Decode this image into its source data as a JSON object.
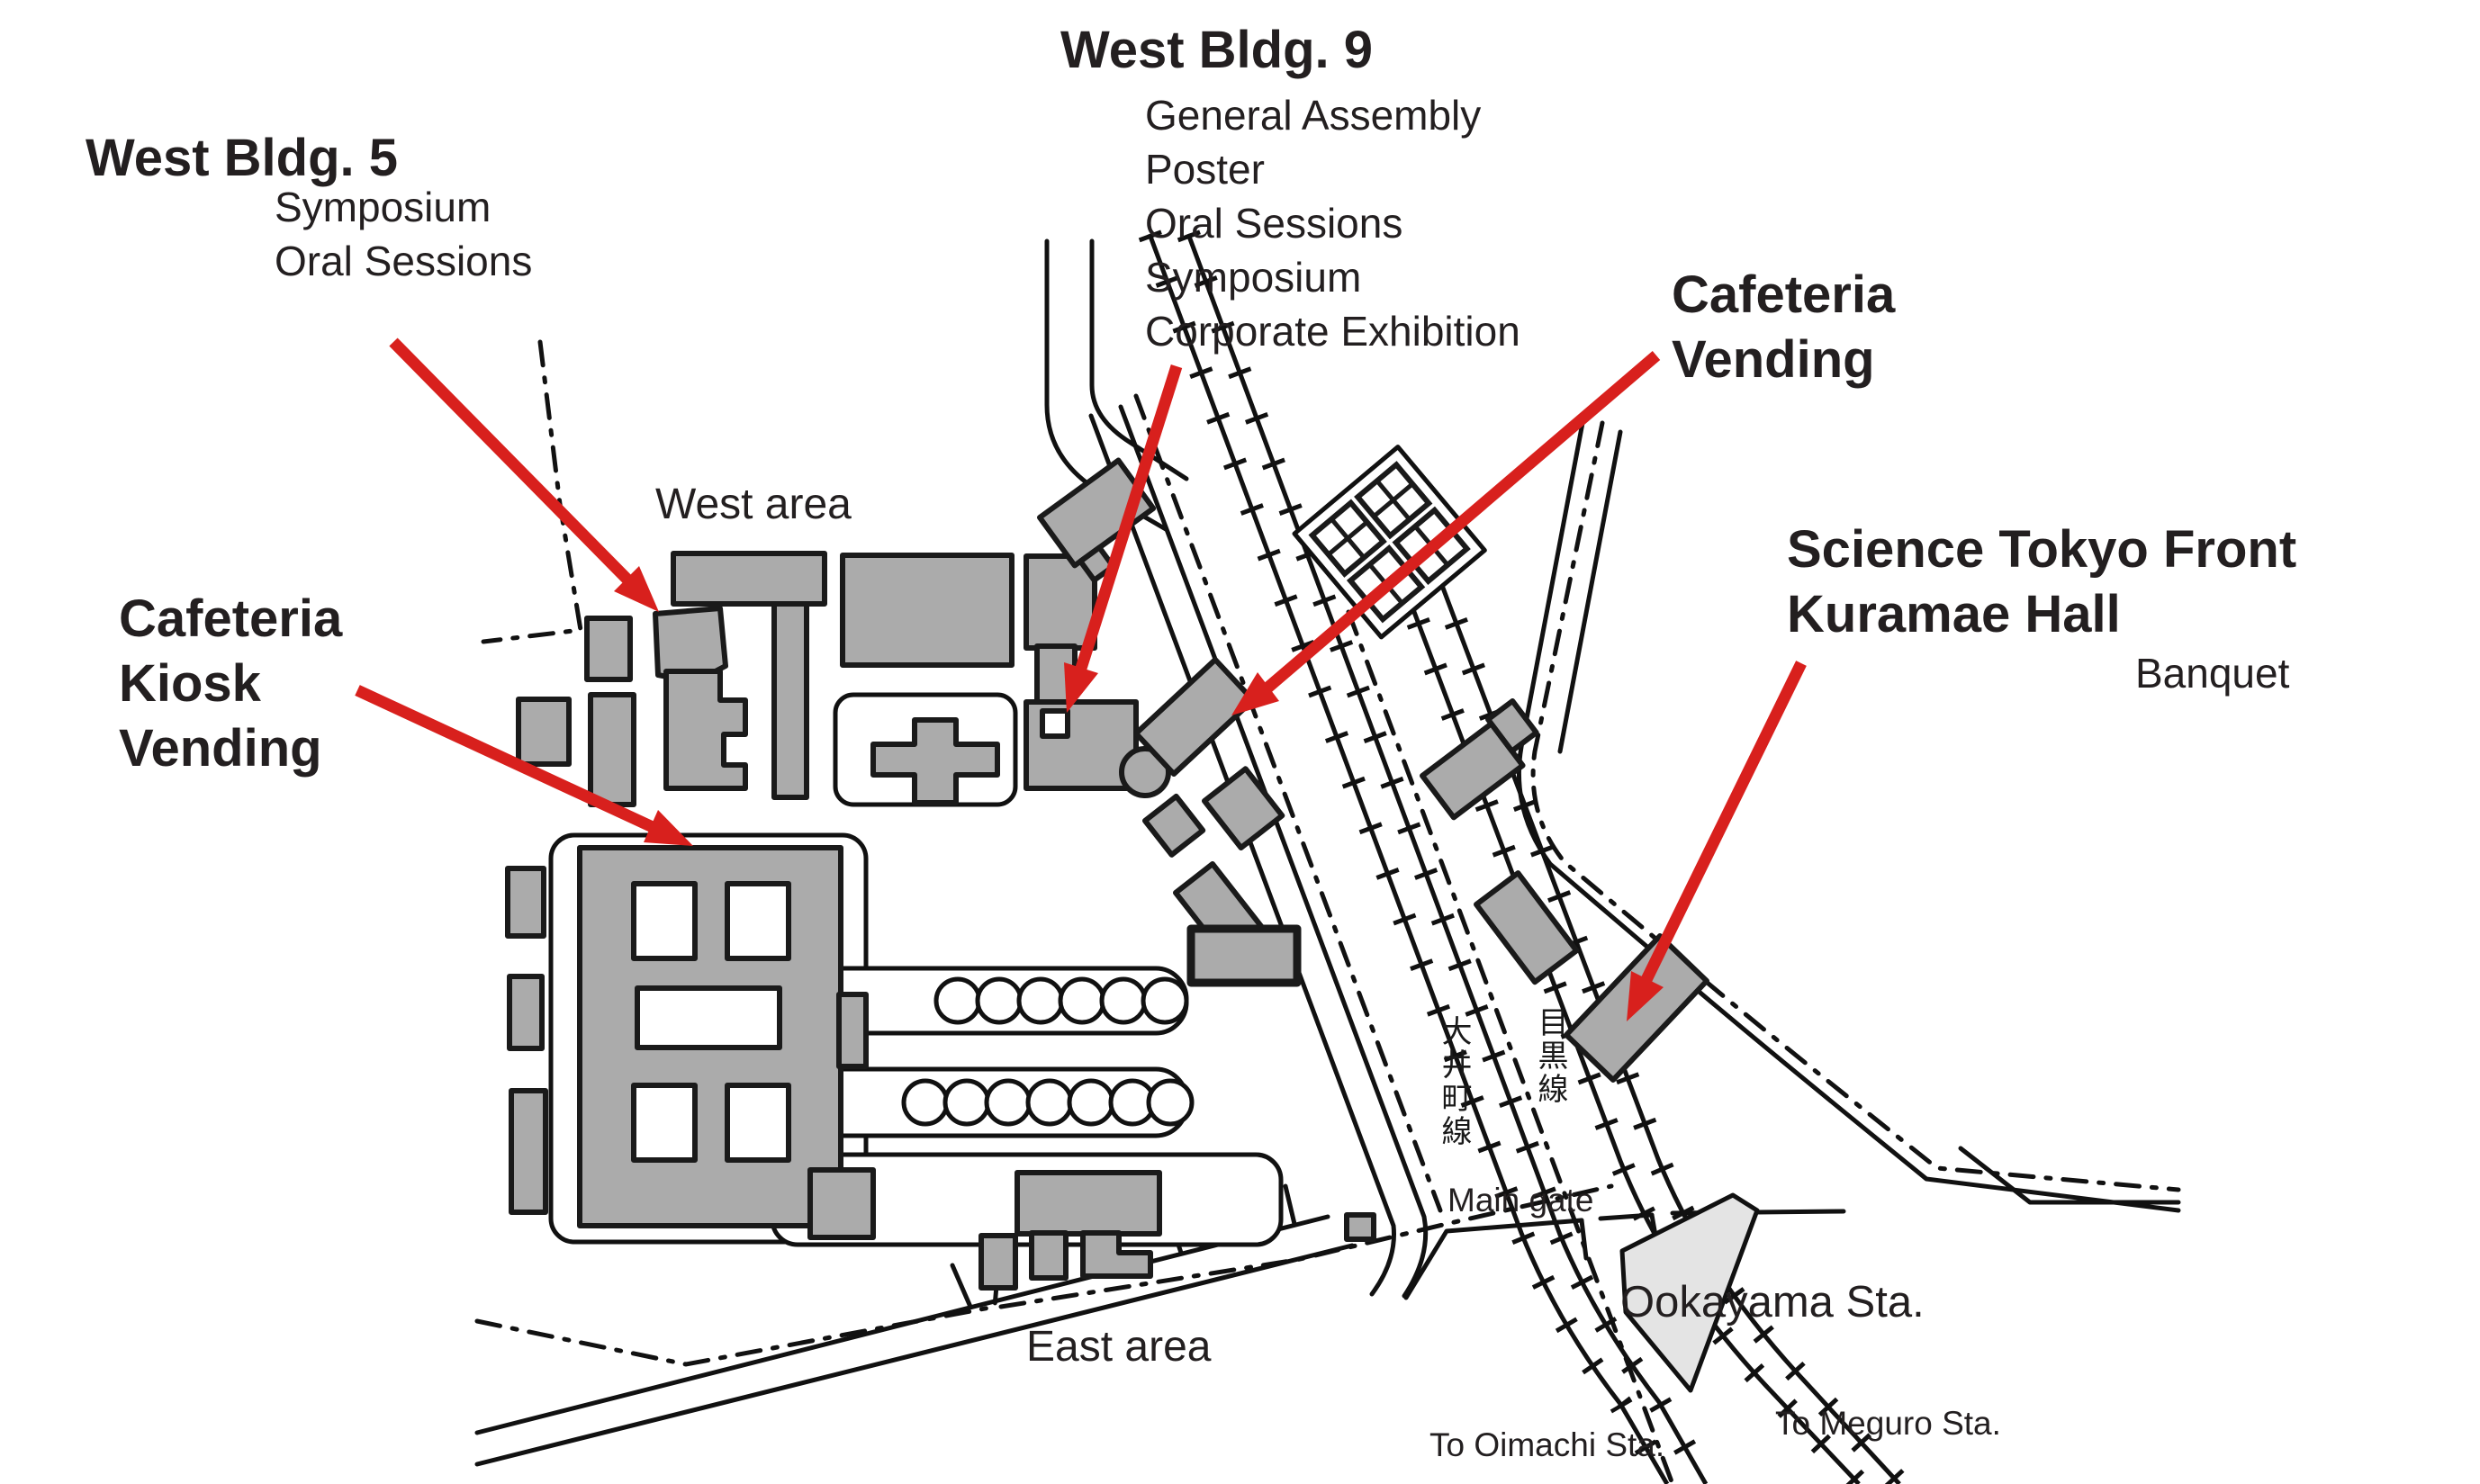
{
  "labels": {
    "west_bldg_5": {
      "title": "West Bldg. 5",
      "items": [
        "Symposium",
        "Oral Sessions"
      ]
    },
    "west_bldg_9": {
      "title": "West Bldg. 9",
      "items": [
        "General Assembly",
        "Poster",
        "Oral Sessions",
        "Symposium",
        "Corporate Exhibition"
      ]
    },
    "cafeteria_vending": {
      "line1": "Cafeteria",
      "line2": "Vending"
    },
    "cafeteria_kiosk": {
      "line1": "Cafeteria",
      "line2": "Kiosk",
      "line3": "Vending"
    },
    "science_tokyo_front": {
      "line1": "Science Tokyo Front",
      "line2": "Kuramae Hall",
      "sub": "Banquet"
    },
    "west_area": "West area",
    "east_area": "East area",
    "main_gate": "Main gate",
    "ookayama_station": "Ookayama Sta.",
    "to_oimachi": "To Oimachi Sta.",
    "to_meguro": "To Meguro Sta.",
    "oimachi_line_jp": "大井町線",
    "meguro_line_jp": "目黒線"
  },
  "colors": {
    "building_fill": "#ABABAB",
    "building_stroke": "#1A1A1A",
    "line_black": "#111111",
    "station_fill": "#E4E4E4",
    "arrow_red": "#D8201D"
  }
}
